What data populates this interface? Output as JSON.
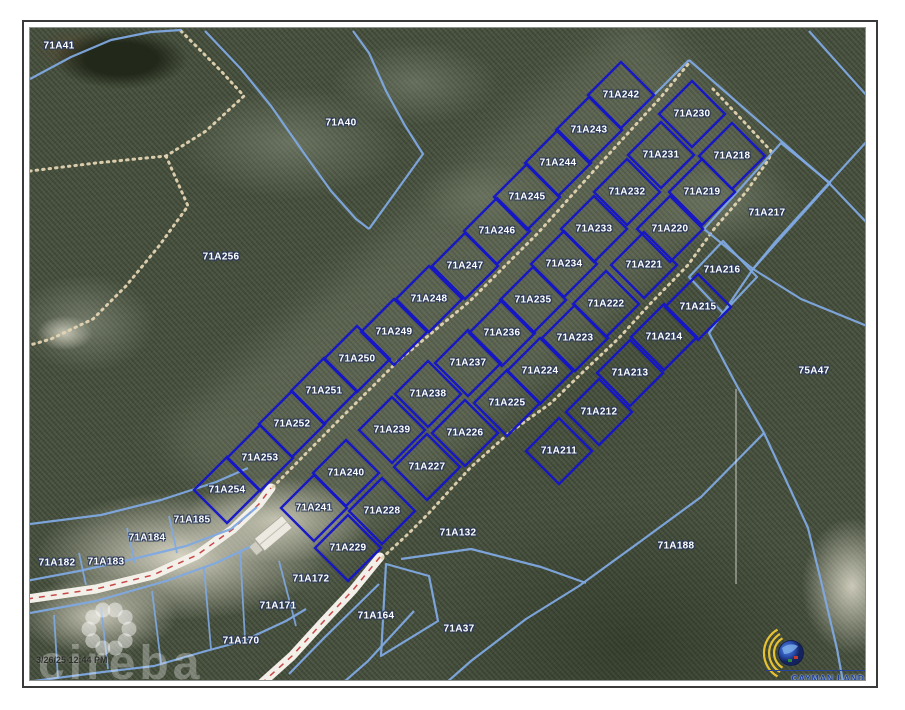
{
  "map": {
    "region_parcels": [
      {
        "label": "71A41",
        "x": 58,
        "y": 45
      },
      {
        "label": "71A40",
        "x": 340,
        "y": 122
      },
      {
        "label": "71A256",
        "x": 220,
        "y": 256
      },
      {
        "label": "75A47",
        "x": 813,
        "y": 370
      },
      {
        "label": "71A217",
        "x": 766,
        "y": 212
      },
      {
        "label": "71A216",
        "x": 721,
        "y": 269
      },
      {
        "label": "71A185",
        "x": 191,
        "y": 519
      },
      {
        "label": "71A184",
        "x": 146,
        "y": 537
      },
      {
        "label": "71A183",
        "x": 105,
        "y": 561
      },
      {
        "label": "71A182",
        "x": 56,
        "y": 562
      },
      {
        "label": "71A132",
        "x": 457,
        "y": 532
      },
      {
        "label": "71A188",
        "x": 675,
        "y": 545
      },
      {
        "label": "71A172",
        "x": 310,
        "y": 578
      },
      {
        "label": "71A171",
        "x": 277,
        "y": 605
      },
      {
        "label": "71A170",
        "x": 240,
        "y": 640
      },
      {
        "label": "71A164",
        "x": 375,
        "y": 615
      },
      {
        "label": "71A37",
        "x": 458,
        "y": 628
      }
    ],
    "subdivision_parcels": [
      {
        "label": "71A211",
        "x": 558,
        "y": 450
      },
      {
        "label": "71A212",
        "x": 598,
        "y": 411
      },
      {
        "label": "71A213",
        "x": 629,
        "y": 372
      },
      {
        "label": "71A214",
        "x": 663,
        "y": 336
      },
      {
        "label": "71A215",
        "x": 697,
        "y": 306
      },
      {
        "label": "71A218",
        "x": 731,
        "y": 155
      },
      {
        "label": "71A219",
        "x": 701,
        "y": 191
      },
      {
        "label": "71A220",
        "x": 669,
        "y": 228
      },
      {
        "label": "71A221",
        "x": 643,
        "y": 264
      },
      {
        "label": "71A222",
        "x": 605,
        "y": 303
      },
      {
        "label": "71A223",
        "x": 574,
        "y": 337
      },
      {
        "label": "71A224",
        "x": 539,
        "y": 370
      },
      {
        "label": "71A225",
        "x": 506,
        "y": 402
      },
      {
        "label": "71A226",
        "x": 464,
        "y": 432
      },
      {
        "label": "71A227",
        "x": 426,
        "y": 466
      },
      {
        "label": "71A228",
        "x": 381,
        "y": 510
      },
      {
        "label": "71A229",
        "x": 347,
        "y": 547
      },
      {
        "label": "71A230",
        "x": 691,
        "y": 113
      },
      {
        "label": "71A231",
        "x": 660,
        "y": 154
      },
      {
        "label": "71A232",
        "x": 626,
        "y": 191
      },
      {
        "label": "71A233",
        "x": 593,
        "y": 228
      },
      {
        "label": "71A234",
        "x": 563,
        "y": 263
      },
      {
        "label": "71A235",
        "x": 532,
        "y": 299
      },
      {
        "label": "71A236",
        "x": 501,
        "y": 332
      },
      {
        "label": "71A237",
        "x": 467,
        "y": 362
      },
      {
        "label": "71A238",
        "x": 427,
        "y": 393
      },
      {
        "label": "71A239",
        "x": 391,
        "y": 429
      },
      {
        "label": "71A240",
        "x": 345,
        "y": 472
      },
      {
        "label": "71A241",
        "x": 313,
        "y": 507
      },
      {
        "label": "71A242",
        "x": 620,
        "y": 94
      },
      {
        "label": "71A243",
        "x": 588,
        "y": 129
      },
      {
        "label": "71A244",
        "x": 557,
        "y": 162
      },
      {
        "label": "71A245",
        "x": 526,
        "y": 196
      },
      {
        "label": "71A246",
        "x": 496,
        "y": 230
      },
      {
        "label": "71A247",
        "x": 464,
        "y": 265
      },
      {
        "label": "71A248",
        "x": 428,
        "y": 298
      },
      {
        "label": "71A249",
        "x": 393,
        "y": 331
      },
      {
        "label": "71A250",
        "x": 356,
        "y": 358
      },
      {
        "label": "71A251",
        "x": 323,
        "y": 390
      },
      {
        "label": "71A252",
        "x": 291,
        "y": 423
      },
      {
        "label": "71A253",
        "x": 259,
        "y": 457
      },
      {
        "label": "71A254",
        "x": 226,
        "y": 489
      }
    ]
  },
  "watermark": {
    "brand": "cireba",
    "printed": "3/26/25 12:44 PM"
  },
  "logo": {
    "title": "CAYMAN LAND INFO",
    "website": "www.caymanlandinfo.ky"
  },
  "colors": {
    "subdivision_boundary": "#1414c8",
    "parcel_boundary": "#7fa9e2",
    "road_centerline": "#c84848",
    "trail_dots": "#e3d4b2",
    "label_outline": "#2a3858"
  }
}
